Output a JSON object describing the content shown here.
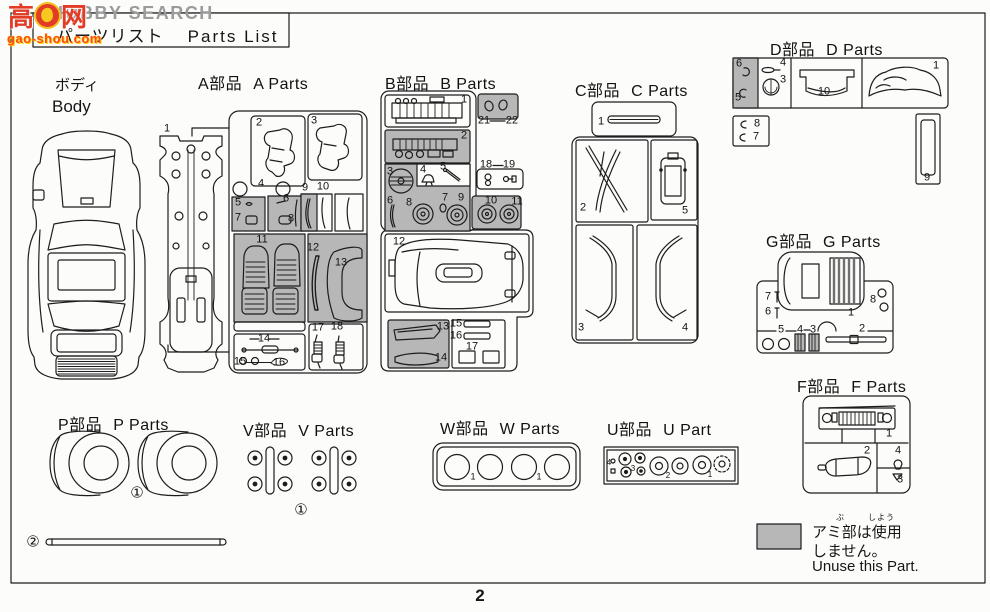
{
  "watermark": {
    "site_text": "HOBBY SEARCH",
    "logo_left": "高",
    "logo_right": "网",
    "domain": "gao-shou.com"
  },
  "header": {
    "title_jp": "パーツリスト",
    "title_en": "Parts List"
  },
  "page_number": "2",
  "sections": {
    "body": {
      "jp": "ボディ",
      "en": "Body"
    },
    "a": {
      "jp": "A部品",
      "en": "A Parts"
    },
    "b": {
      "jp": "B部品",
      "en": "B Parts"
    },
    "c": {
      "jp": "C部品",
      "en": "C Parts"
    },
    "d": {
      "jp": "D部品",
      "en": "D Parts"
    },
    "g": {
      "jp": "G部品",
      "en": "G Parts"
    },
    "f": {
      "jp": "F部品",
      "en": "F Parts"
    },
    "p": {
      "jp": "P部品",
      "en": "P Parts"
    },
    "v": {
      "jp": "V部品",
      "en": "V Parts"
    },
    "w": {
      "jp": "W部品",
      "en": "W Parts"
    },
    "u": {
      "jp": "U部品",
      "en": "U Part"
    }
  },
  "legend": {
    "jp_line1": "アミ部は使用",
    "jp_line2": "しません。",
    "en_line": "Unuse this Part.",
    "furigana_bu": "ぶ",
    "furigana_shiyo": "しよう"
  },
  "colors": {
    "shaded_part_fill": "#b7b7b7",
    "line": "#1d1d1d",
    "watermark_red": "#e23c26",
    "watermark_gray": "#9b9b9b",
    "watermark_orange": "#ff4a1a"
  },
  "part_labels": {
    "a": [
      {
        "t": "1",
        "x": 167,
        "y": 129
      },
      {
        "t": "2",
        "x": 259,
        "y": 123
      },
      {
        "t": "3",
        "x": 314,
        "y": 121
      },
      {
        "t": "4",
        "x": 261,
        "y": 184
      },
      {
        "t": "5",
        "x": 238,
        "y": 203
      },
      {
        "t": "7",
        "x": 238,
        "y": 218
      },
      {
        "t": "6",
        "x": 286,
        "y": 199
      },
      {
        "t": "8",
        "x": 291,
        "y": 219
      },
      {
        "t": "9",
        "x": 305,
        "y": 188
      },
      {
        "t": "10",
        "x": 323,
        "y": 187
      },
      {
        "t": "11",
        "x": 262,
        "y": 240
      },
      {
        "t": "12",
        "x": 313,
        "y": 248
      },
      {
        "t": "13",
        "x": 341,
        "y": 263
      },
      {
        "t": "14",
        "x": 264,
        "y": 339
      },
      {
        "t": "15",
        "x": 240,
        "y": 362
      },
      {
        "t": "16",
        "x": 279,
        "y": 363
      },
      {
        "t": "17",
        "x": 318,
        "y": 328
      },
      {
        "t": "18",
        "x": 337,
        "y": 327
      }
    ],
    "b": [
      {
        "t": "1",
        "x": 464,
        "y": 100
      },
      {
        "t": "21",
        "x": 484,
        "y": 121
      },
      {
        "t": "22",
        "x": 512,
        "y": 121
      },
      {
        "t": "2",
        "x": 464,
        "y": 136
      },
      {
        "t": "3",
        "x": 390,
        "y": 172
      },
      {
        "t": "4",
        "x": 423,
        "y": 170
      },
      {
        "t": "5",
        "x": 443,
        "y": 167
      },
      {
        "t": "18",
        "x": 486,
        "y": 165
      },
      {
        "t": "19",
        "x": 509,
        "y": 165
      },
      {
        "t": "6",
        "x": 390,
        "y": 201
      },
      {
        "t": "8",
        "x": 409,
        "y": 203
      },
      {
        "t": "7",
        "x": 445,
        "y": 198
      },
      {
        "t": "9",
        "x": 461,
        "y": 198
      },
      {
        "t": "10",
        "x": 491,
        "y": 201
      },
      {
        "t": "11",
        "x": 517,
        "y": 202
      },
      {
        "t": "12",
        "x": 399,
        "y": 242
      },
      {
        "t": "13",
        "x": 443,
        "y": 327
      },
      {
        "t": "14",
        "x": 441,
        "y": 358
      },
      {
        "t": "15",
        "x": 456,
        "y": 324
      },
      {
        "t": "16",
        "x": 456,
        "y": 336
      },
      {
        "t": "17",
        "x": 472,
        "y": 347
      }
    ],
    "c": [
      {
        "t": "1",
        "x": 601,
        "y": 122
      },
      {
        "t": "2",
        "x": 583,
        "y": 208
      },
      {
        "t": "5",
        "x": 685,
        "y": 211
      },
      {
        "t": "3",
        "x": 581,
        "y": 328
      },
      {
        "t": "4",
        "x": 685,
        "y": 328
      }
    ],
    "d": [
      {
        "t": "6",
        "x": 739,
        "y": 64
      },
      {
        "t": "5",
        "x": 738,
        "y": 98
      },
      {
        "t": "4",
        "x": 783,
        "y": 63
      },
      {
        "t": "3",
        "x": 783,
        "y": 80
      },
      {
        "t": "10",
        "x": 824,
        "y": 92
      },
      {
        "t": "1",
        "x": 936,
        "y": 66
      },
      {
        "t": "8",
        "x": 757,
        "y": 124
      },
      {
        "t": "7",
        "x": 756,
        "y": 137
      },
      {
        "t": "9",
        "x": 927,
        "y": 178
      }
    ],
    "g": [
      {
        "t": "7",
        "x": 768,
        "y": 297
      },
      {
        "t": "6",
        "x": 768,
        "y": 312
      },
      {
        "t": "1",
        "x": 851,
        "y": 313
      },
      {
        "t": "8",
        "x": 873,
        "y": 300
      },
      {
        "t": "5",
        "x": 781,
        "y": 330
      },
      {
        "t": "4",
        "x": 800,
        "y": 330
      },
      {
        "t": "3",
        "x": 813,
        "y": 330
      },
      {
        "t": "2",
        "x": 862,
        "y": 329
      }
    ],
    "f": [
      {
        "t": "1",
        "x": 889,
        "y": 434
      },
      {
        "t": "2",
        "x": 867,
        "y": 451
      },
      {
        "t": "4",
        "x": 898,
        "y": 451
      },
      {
        "t": "3",
        "x": 900,
        "y": 480
      }
    ],
    "p": [
      {
        "t": "①",
        "x": 137,
        "y": 493,
        "s": 15
      },
      {
        "t": "②",
        "x": 33,
        "y": 542,
        "s": 15
      }
    ],
    "v": [
      {
        "t": "①",
        "x": 301,
        "y": 510,
        "s": 15
      }
    ],
    "w": [
      {
        "t": "1",
        "x": 473,
        "y": 477,
        "s": 9
      },
      {
        "t": "1",
        "x": 539,
        "y": 477,
        "s": 9
      }
    ],
    "u": [
      {
        "t": "4",
        "x": 609,
        "y": 463,
        "s": 8
      },
      {
        "t": "3",
        "x": 633,
        "y": 469,
        "s": 8
      },
      {
        "t": "2",
        "x": 668,
        "y": 476,
        "s": 8
      },
      {
        "t": "1",
        "x": 710,
        "y": 475,
        "s": 8
      }
    ]
  }
}
